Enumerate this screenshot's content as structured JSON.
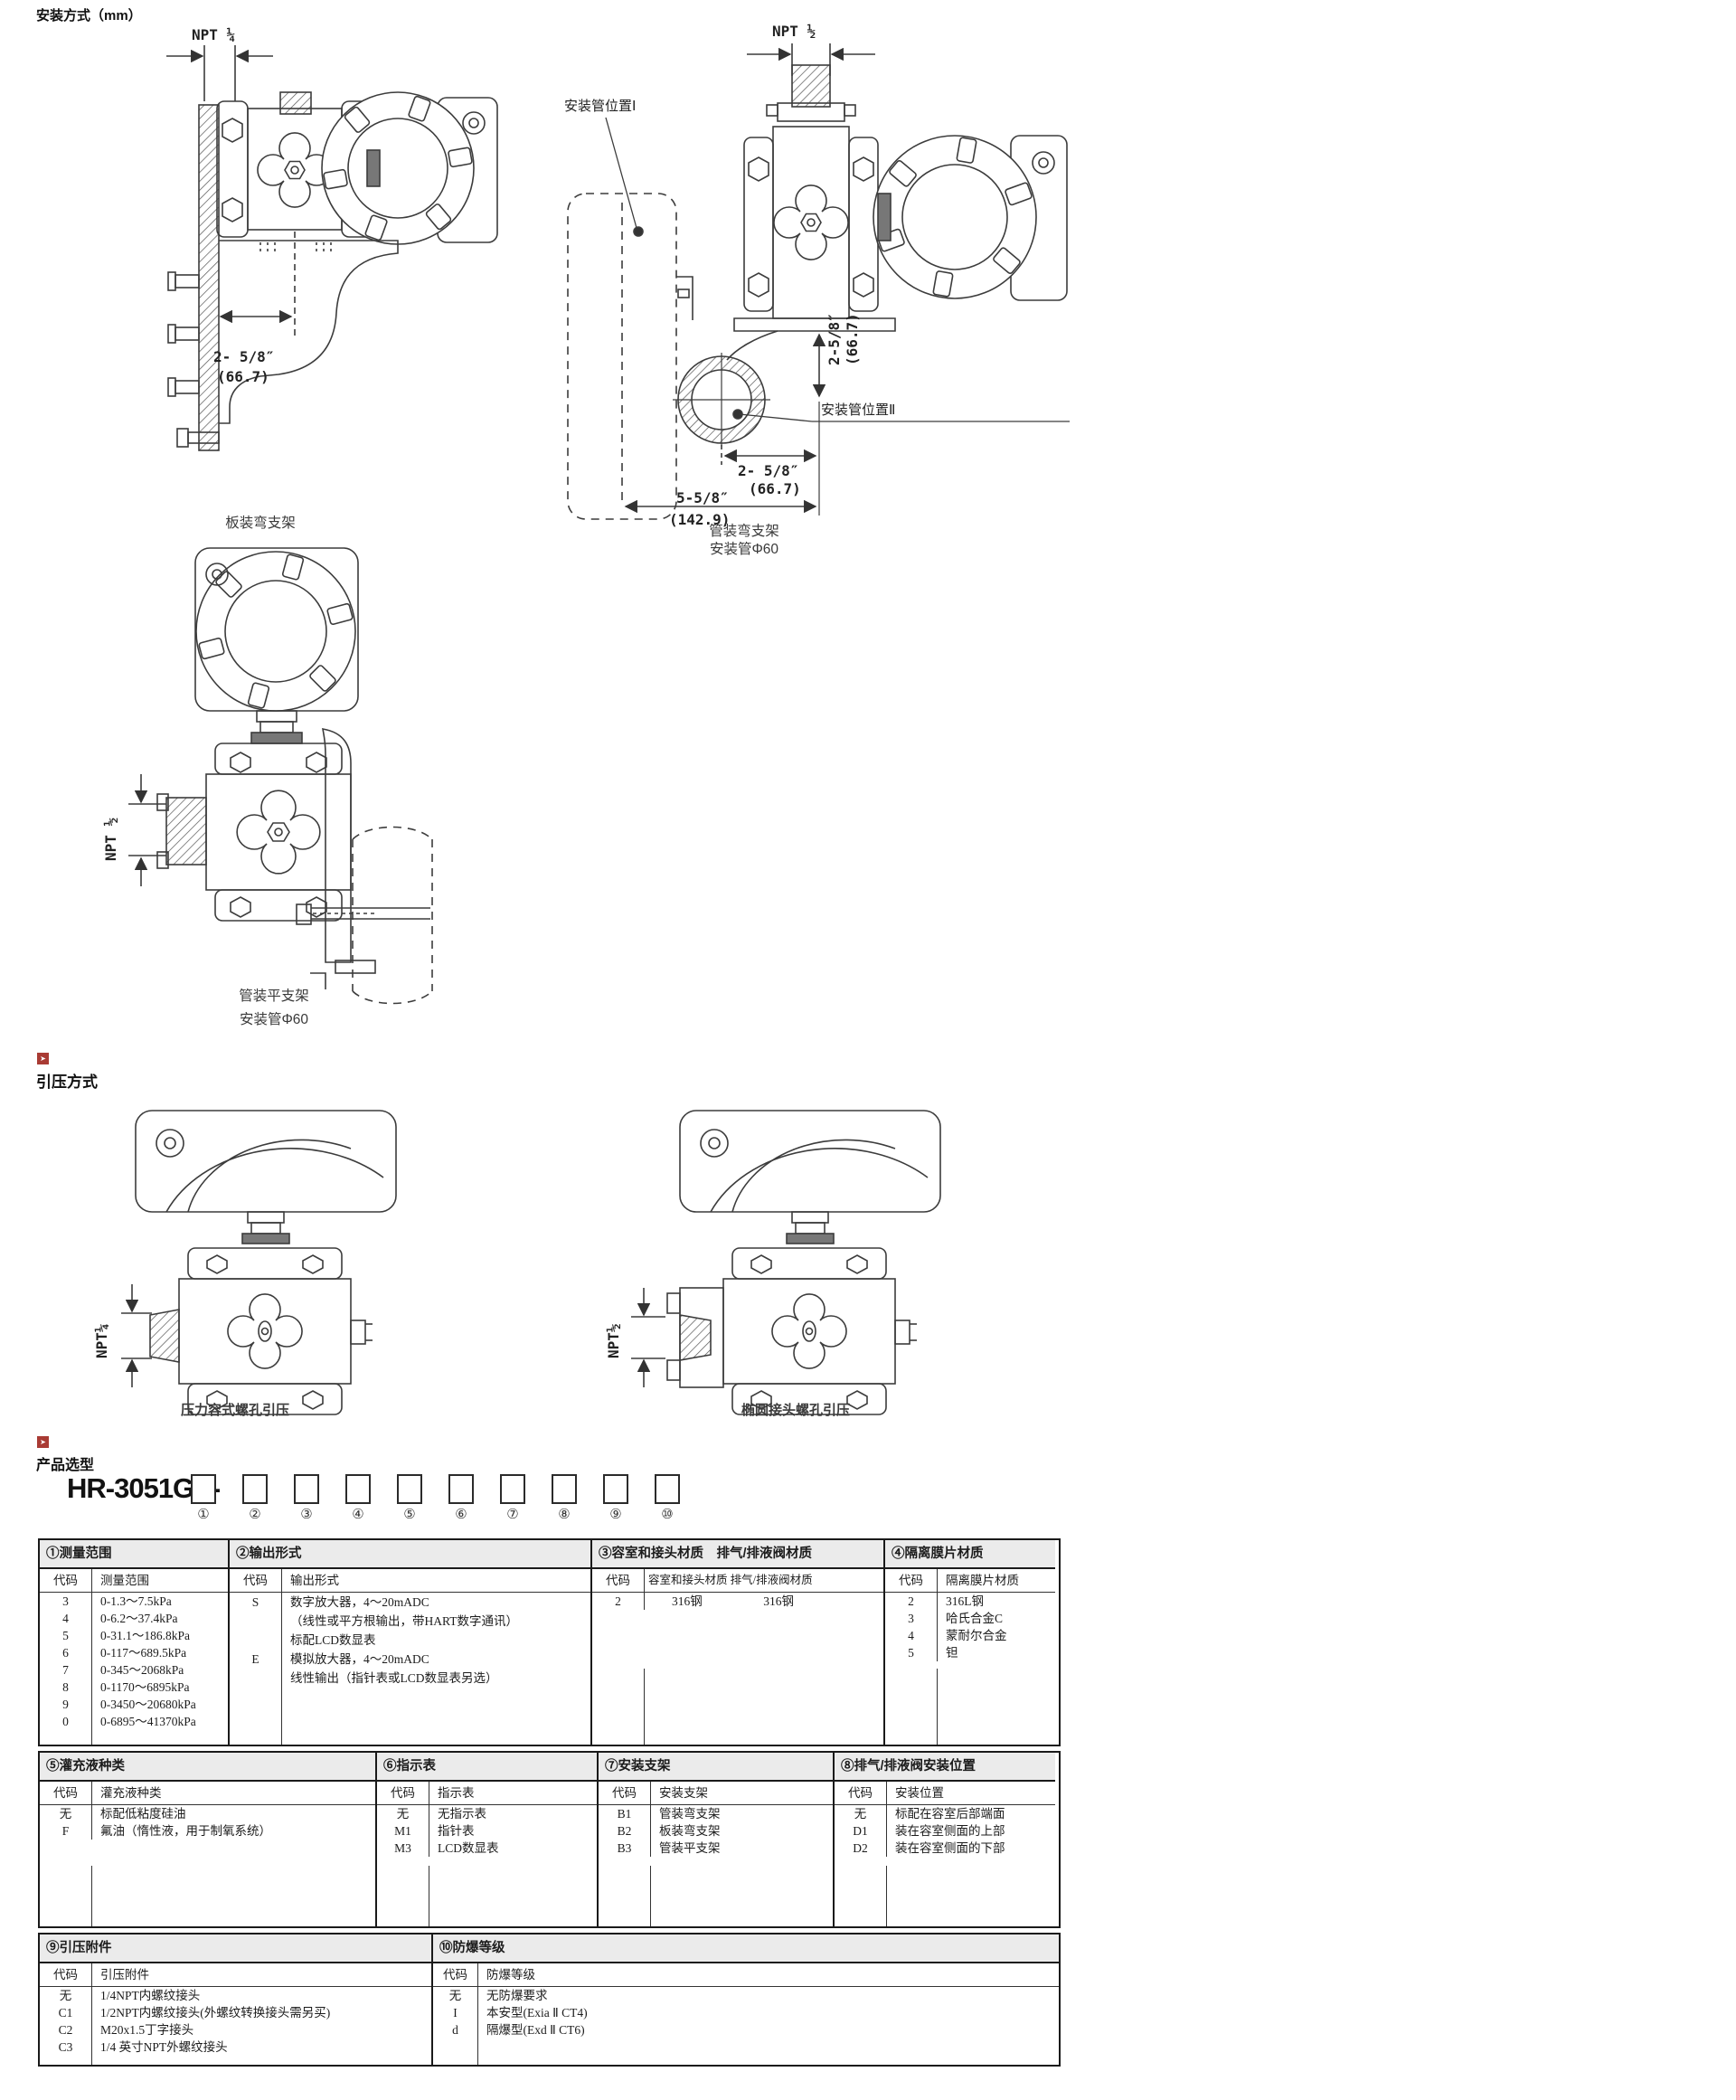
{
  "page": {
    "section1_title": "安装方式（mm）",
    "section2_title": "引压方式",
    "section3_title": "产品选型",
    "model_prefix": "HR-3051GP-",
    "position_numbers": [
      "①",
      "②",
      "③",
      "④",
      "⑤",
      "⑥",
      "⑦",
      "⑧",
      "⑨",
      "⑩"
    ],
    "accent_red": "#a93b34",
    "flag_glyph": "➤"
  },
  "diagrams": {
    "panel_bracket": {
      "npt_label": "NPT ¼",
      "dim1_line1": "2- 5/8″",
      "dim1_line2": "(66.7)",
      "caption": "板装弯支架"
    },
    "pipe_bent_bracket": {
      "npt_label": "NPT ½",
      "pipe_pos1_label": "安装管位置Ⅰ",
      "pipe_pos2_label": "安装管位置Ⅱ",
      "dim_v_line1": "2-5/8″",
      "dim_v_line2": "(66.7)",
      "dim_h1_line1": "2- 5/8″",
      "dim_h1_line2": "(66.7)",
      "dim_h2_line1": "5-5/8″",
      "dim_h2_line2": "(142.9)",
      "caption_line1": "管装弯支架",
      "caption_line2": "安装管Φ60"
    },
    "pipe_flat_bracket": {
      "npt_label": "NPT ½",
      "caption_line1": "管装平支架",
      "caption_line2": "安装管Φ60"
    },
    "tapping_left": {
      "npt_label": "NPT¼",
      "caption": "压力容式螺孔引压"
    },
    "tapping_right": {
      "npt_label": "NPT½",
      "caption": "椭圆接头螺孔引压"
    }
  },
  "tables": {
    "t1": {
      "title": "①测量范围",
      "code_hdr": "代码",
      "val_hdr": "测量范围",
      "rows": [
        [
          "3",
          "0-1.3～7.5kPa"
        ],
        [
          "4",
          "0-6.2～37.4kPa"
        ],
        [
          "5",
          "0-31.1～186.8kPa"
        ],
        [
          "6",
          "0-117～689.5kPa"
        ],
        [
          "7",
          "0-345～2068kPa"
        ],
        [
          "8",
          "0-1170～6895kPa"
        ],
        [
          "9",
          "0-3450～20680kPa"
        ],
        [
          "0",
          "0-6895～41370kPa"
        ]
      ]
    },
    "t2": {
      "title": "②输出形式",
      "code_hdr": "代码",
      "val_hdr": "输出形式",
      "rows": [
        [
          "S",
          "数字放大器，4～20mADC"
        ],
        [
          "",
          "（线性或平方根输出，带HART数字通讯）"
        ],
        [
          "",
          "标配LCD数显表"
        ],
        [
          "E",
          "模拟放大器，4～20mADC"
        ],
        [
          "",
          "线性输出（指针表或LCD数显表另选）"
        ]
      ]
    },
    "t3": {
      "title": "③容室和接头材质　排气/排液阀材质",
      "code_hdr": "代码",
      "val_hdr": "容室和接头材质  排气/排液阀材质",
      "rows": [
        [
          "2",
          "316钢　　　　　316钢"
        ]
      ]
    },
    "t4": {
      "title": "④隔离膜片材质",
      "code_hdr": "代码",
      "val_hdr": "隔离膜片材质",
      "rows": [
        [
          "2",
          "316L钢"
        ],
        [
          "3",
          "哈氏合金C"
        ],
        [
          "4",
          "蒙耐尔合金"
        ],
        [
          "5",
          "钽"
        ]
      ]
    },
    "t5": {
      "title": "⑤灌充液种类",
      "code_hdr": "代码",
      "val_hdr": "灌充液种类",
      "rows": [
        [
          "无",
          "标配低粘度硅油"
        ],
        [
          "F",
          "氟油（惰性液，用于制氧系统）"
        ]
      ]
    },
    "t6": {
      "title": "⑥指示表",
      "code_hdr": "代码",
      "val_hdr": "指示表",
      "rows": [
        [
          "无",
          "无指示表"
        ],
        [
          "M1",
          "指针表"
        ],
        [
          "M3",
          "LCD数显表"
        ]
      ]
    },
    "t7": {
      "title": "⑦安装支架",
      "code_hdr": "代码",
      "val_hdr": "安装支架",
      "rows": [
        [
          "B1",
          "管装弯支架"
        ],
        [
          "B2",
          "板装弯支架"
        ],
        [
          "B3",
          "管装平支架"
        ]
      ]
    },
    "t8": {
      "title": "⑧排气/排液阀安装位置",
      "code_hdr": "代码",
      "val_hdr": "安装位置",
      "rows": [
        [
          "无",
          "标配在容室后部端面"
        ],
        [
          "D1",
          "装在容室侧面的上部"
        ],
        [
          "D2",
          "装在容室侧面的下部"
        ]
      ]
    },
    "t9": {
      "title": "⑨引压附件",
      "code_hdr": "代码",
      "val_hdr": "引压附件",
      "rows": [
        [
          "无",
          "1/4NPT内螺纹接头"
        ],
        [
          "C1",
          "1/2NPT内螺纹接头(外螺纹转换接头需另买)"
        ],
        [
          "C2",
          "M20x1.5丁字接头"
        ],
        [
          "C3",
          "1/4 英寸NPT外螺纹接头"
        ]
      ]
    },
    "t10": {
      "title": "⑩防爆等级",
      "code_hdr": "代码",
      "val_hdr": "防爆等级",
      "rows": [
        [
          "无",
          "无防爆要求"
        ],
        [
          "I",
          "本安型(Exia Ⅱ CT4)"
        ],
        [
          "d",
          "隔爆型(Exd Ⅱ CT6)"
        ]
      ]
    }
  }
}
